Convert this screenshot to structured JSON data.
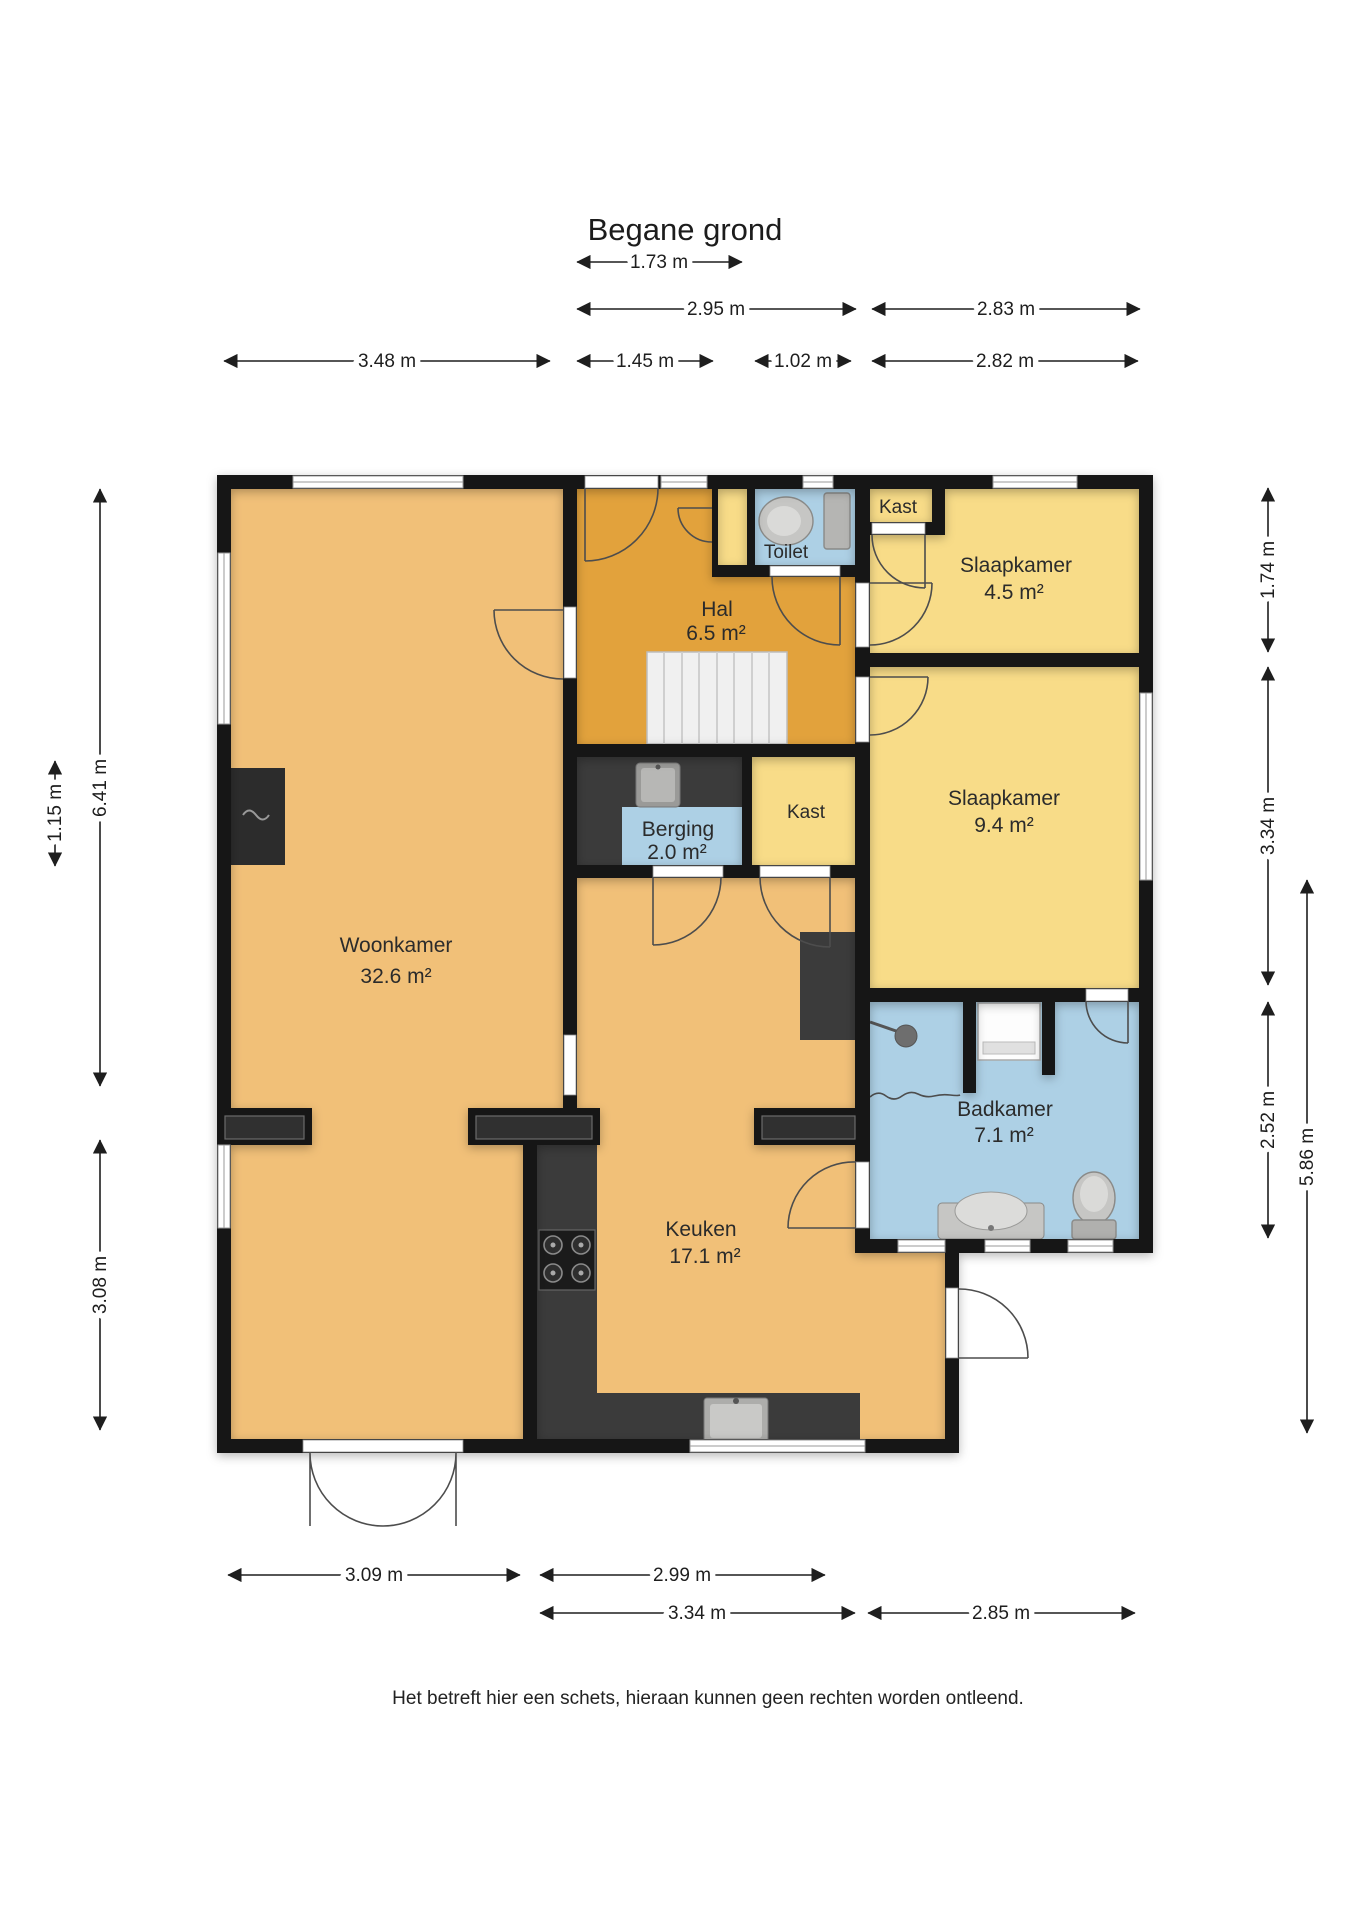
{
  "title": "Begane grond",
  "disclaimer": "Het betreft hier een schets, hieraan kunnen geen rechten worden ontleend.",
  "rooms": {
    "woonkamer": {
      "name": "Woonkamer",
      "area": "32.6 m²"
    },
    "hal": {
      "name": "Hal",
      "area": "6.5 m²"
    },
    "toilet": {
      "name": "Toilet"
    },
    "kast_boven": {
      "name": "Kast"
    },
    "slaapkamer_klein": {
      "name": "Slaapkamer",
      "area": "4.5 m²"
    },
    "slaapkamer_groot": {
      "name": "Slaapkamer",
      "area": "9.4 m²"
    },
    "berging": {
      "name": "Berging",
      "area": "2.0 m²"
    },
    "kast_midden": {
      "name": "Kast"
    },
    "badkamer": {
      "name": "Badkamer",
      "area": "7.1 m²"
    },
    "keuken": {
      "name": "Keuken",
      "area": "17.1 m²"
    }
  },
  "dimensions": {
    "top": [
      "1.73 m",
      "2.95 m",
      "2.83 m",
      "3.48 m",
      "1.45 m",
      "1.02 m",
      "2.82 m"
    ],
    "bottom": [
      "3.09 m",
      "2.99 m",
      "3.34 m",
      "2.85 m"
    ],
    "left": [
      "1.15 m",
      "6.41 m",
      "3.08 m"
    ],
    "right": [
      "1.74 m",
      "3.34 m",
      "2.52 m",
      "5.86 m"
    ]
  },
  "colors": {
    "floor_living": "#F1C078",
    "floor_hall": "#E2A23C",
    "floor_bedroom": "#F8DC88",
    "floor_wet": "#ADD0E5",
    "wall": "#161616"
  }
}
